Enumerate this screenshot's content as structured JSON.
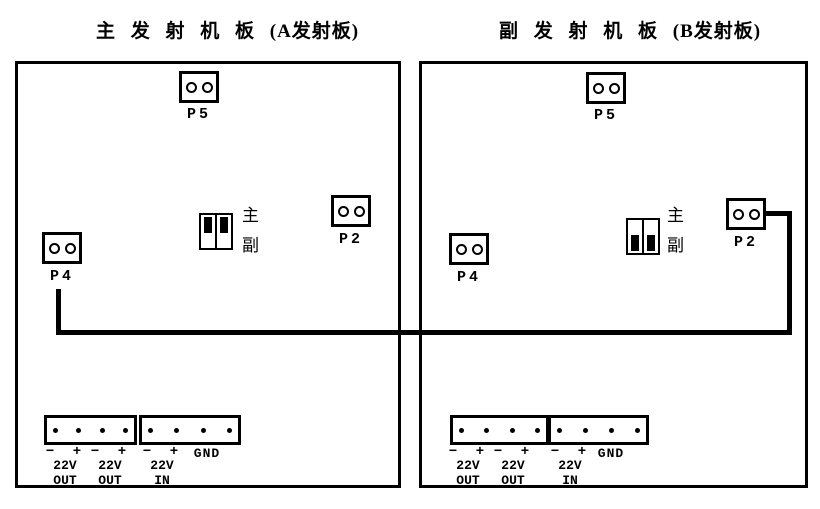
{
  "diagram": {
    "titles": {
      "board_a": "主 发 射 机 板 (A发射板)",
      "board_b": "副 发 射 机 板 (B发射板)"
    },
    "boards": [
      {
        "id": "A",
        "p5_label": "P5",
        "p2_label": "P2",
        "p4_label": "P4",
        "jumper": {
          "position": "top",
          "label_top": "主",
          "label_bottom": "副"
        },
        "power_groups": [
          {
            "signs": "− +",
            "volt": "22V",
            "dir": "OUT"
          },
          {
            "signs": "− +",
            "volt": "22V",
            "dir": "OUT"
          },
          {
            "signs": "− +",
            "volt": "22V",
            "dir": "IN"
          }
        ],
        "gnd_label": "GND"
      },
      {
        "id": "B",
        "p5_label": "P5",
        "p2_label": "P2",
        "p4_label": "P4",
        "jumper": {
          "position": "bottom",
          "label_top": "主",
          "label_bottom": "副"
        },
        "power_groups": [
          {
            "signs": "− +",
            "volt": "22V",
            "dir": "OUT"
          },
          {
            "signs": "− +",
            "volt": "22V",
            "dir": "OUT"
          },
          {
            "signs": "− +",
            "volt": "22V",
            "dir": "IN"
          }
        ],
        "gnd_label": "GND"
      }
    ],
    "connection": {
      "from": "P4",
      "to": "P2"
    },
    "colors": {
      "ink": "#000000",
      "background": "#ffffff"
    }
  }
}
